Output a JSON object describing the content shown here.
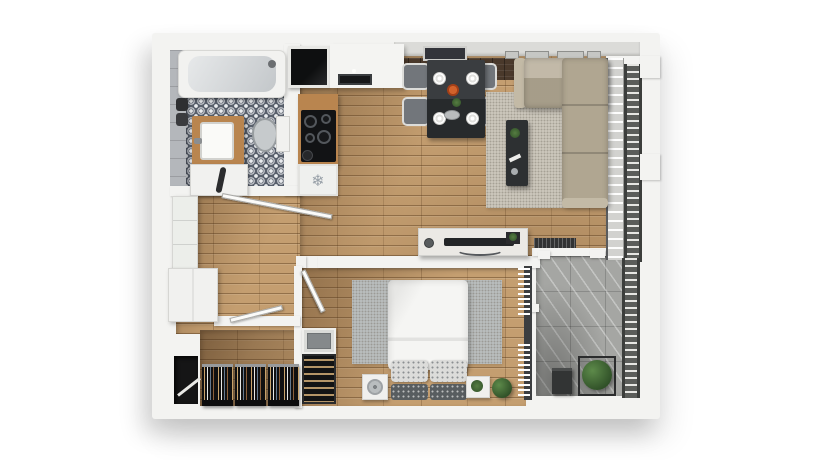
{
  "palette": {
    "page_bg": "#ffffff",
    "wall": "#f3f3f1",
    "wood": "#c49e70",
    "counter_wood": "#b9854f",
    "tile": "#59606c",
    "tile_motif": "#e9ebee",
    "concrete": "#a5a6a3",
    "sofa": "#b4aa95",
    "rug_living": "#cbc6bb",
    "rug_bedroom": "#b9bdbd",
    "furniture_dark": "#2e3134",
    "chair": "#72767b",
    "bed_linen": "#f5f5f3",
    "railing": "#5b5d5a",
    "brick": "#4a392b",
    "plant": "#2f4f27",
    "accent_orange": "#d2622b",
    "clothes_dark": "#141415",
    "screen_gray": "#85898b"
  },
  "icons": {
    "freezer_snowflake": "❄"
  },
  "scene": {
    "type": "apartment-floor-plan-3d-top-view",
    "rooms": [
      {
        "name": "bathroom",
        "furniture": [
          "bathtub",
          "vanity-sink",
          "toilet",
          "washing-machine",
          "towels"
        ]
      },
      {
        "name": "kitchen",
        "furniture": [
          "cooktop",
          "kitchen-sink",
          "fridge-freezer",
          "counters"
        ]
      },
      {
        "name": "dining-area",
        "furniture": [
          "dining-table",
          "4-chairs",
          "4-plates"
        ]
      },
      {
        "name": "living-room",
        "furniture": [
          "l-shaped-sofa",
          "coffee-table",
          "area-rug",
          "tv-console",
          "tv"
        ]
      },
      {
        "name": "bedroom",
        "furniture": [
          "double-bed",
          "2-nightstands",
          "wine-rack",
          "plants"
        ]
      },
      {
        "name": "walk-in-closet",
        "furniture": [
          "3-clothes-racks",
          "entry-door"
        ]
      },
      {
        "name": "balcony",
        "furniture": [
          "planter",
          "plant",
          "railing",
          "bench-mat"
        ]
      },
      {
        "name": "hallway",
        "furniture": [
          "wardrobe-cabinets",
          "doors"
        ]
      }
    ]
  }
}
